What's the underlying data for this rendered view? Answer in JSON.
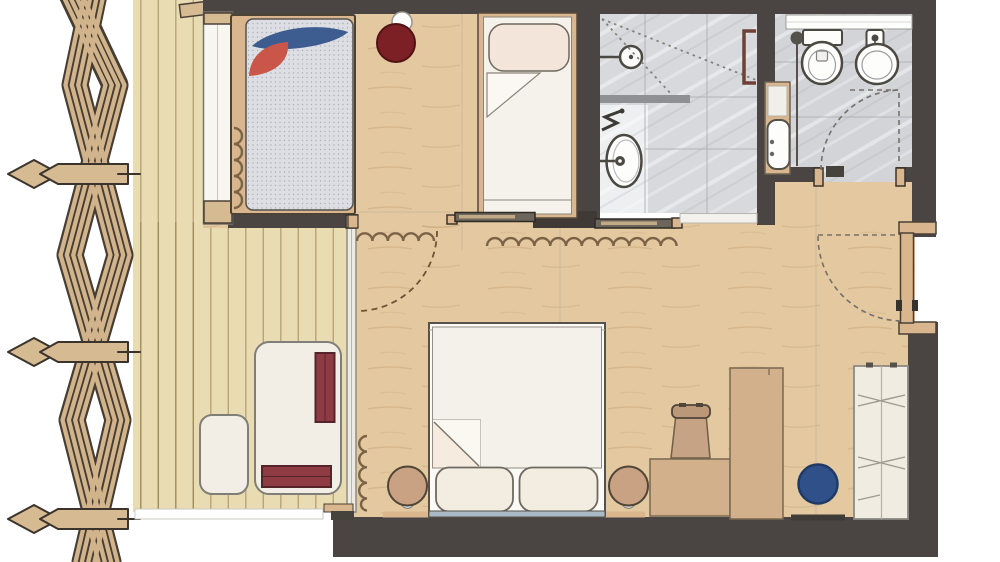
{
  "meta": {
    "type": "architectural floor plan"
  },
  "palette": {
    "wall": "#4a4542",
    "wood": "#e4c89f",
    "deck": "#e9dcb2",
    "tile": "#d7d9dc",
    "tile2": "#d2d4d8",
    "tileLight": "#edeff0",
    "furnWood": "#d9b68e",
    "beam": "#d6ba92",
    "latticeWood": "#d2b48c",
    "latticeDark": "#463d33",
    "line": "#4c4842",
    "pillowBlue": "#3d5c90",
    "pillowRed": "#c95648",
    "poufDarkRed": "#7d2026",
    "cushionRed": "#8e3b44",
    "poufTan": "#c9a183",
    "bluePouf": "#30508a",
    "curtain": "#7b6347",
    "doorArc": "#6e5334",
    "dash": "#76706a",
    "mattress": "#dcdee3",
    "duvet": "#f4f1ea",
    "lounge": "#f2eee6",
    "glass": "#eceae2"
  },
  "plan": {
    "zones": [
      {
        "name": "pergola-lattice-screen",
        "objects": [
          "crossed-slat-bands",
          "pointed-tie-beams"
        ]
      },
      {
        "name": "terrace-deck",
        "objects": [
          "lounge-daybed",
          "red-seat-cushion-vertical",
          "red-seat-cushion-horizontal",
          "side-table",
          "deck-fascia"
        ]
      },
      {
        "name": "bedroom-left",
        "objects": [
          "double-bed",
          "dotted-mattress",
          "blue-leaf-pillow",
          "red-leaf-pillow",
          "dark-red-pouf",
          "ceiling-light",
          "window-strip",
          "window-curtain"
        ]
      },
      {
        "name": "single-bed-nook",
        "objects": [
          "single-bed",
          "pillow",
          "folded-blanket"
        ]
      },
      {
        "name": "shower-room",
        "objects": [
          "shower-head",
          "spray-lines",
          "half-wall",
          "washbasin",
          "towel-hook",
          "wall-niche"
        ]
      },
      {
        "name": "wc",
        "objects": [
          "toilet",
          "bidet",
          "vanity-basin",
          "floor-drain",
          "window-band",
          "hinged-door-swing"
        ]
      },
      {
        "name": "living-room",
        "objects": [
          "double-bed",
          "duvet-fold",
          "bed-pillows",
          "bedside-pouf-left",
          "bedside-pouf-right",
          "desk",
          "desk-chair",
          "tall-cabinet",
          "blue-pouf",
          "wardrobe",
          "door-mat",
          "curtain-squiggles",
          "sliding-doors",
          "glass-wall"
        ]
      },
      {
        "name": "entry",
        "objects": [
          "entrance-door",
          "door-swing-arc"
        ]
      }
    ]
  }
}
